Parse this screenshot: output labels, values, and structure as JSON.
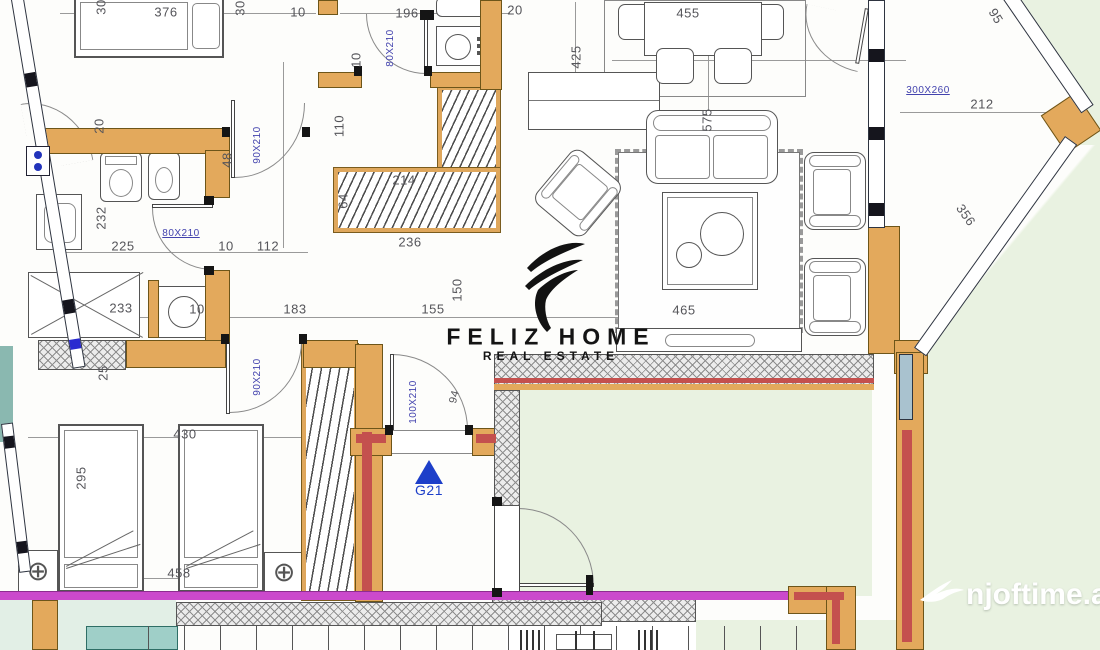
{
  "labels": {
    "b1_width": "376",
    "top_10": "10",
    "top_30a": "30",
    "top_30b": "30",
    "bath2_width": "196",
    "top_20": "20",
    "dining_width": "455",
    "bay_top": "95",
    "left_20": "20",
    "bed1_door": "90X210",
    "bath2_door": "80X210",
    "kitchen_h": "425",
    "hall_110": "110",
    "bath2_10": "10",
    "door_48": "48",
    "bath1_h": "232",
    "bath1_w": "225",
    "bath1_door": "80X210",
    "hall_10": "10",
    "hall_112": "112",
    "ward_64": "64",
    "ward_214": "214",
    "ward_236": "236",
    "living_h": "575",
    "shower_233": "233",
    "wash_10": "10",
    "hall_183": "183",
    "hall_155": "155",
    "hall_150": "150",
    "bay_tag": "300X260",
    "bay_212": "212",
    "bay_356": "356",
    "rug_465": "465",
    "bed2_25": "25",
    "bed2_door": "90X210",
    "entry_door": "100X210",
    "entry_94": "94",
    "bed2_430": "430",
    "bed2_295": "295",
    "bed2_458": "458",
    "gate": "G21"
  },
  "watermarks": {
    "brand": "FELIZ HOME",
    "brand_sub": "REAL ESTATE",
    "site": "njoftime.al"
  },
  "icons": {
    "entry_marker": "triangle-up",
    "site_bird": "bird",
    "brand_logo": "swoosh"
  },
  "colors": {
    "wall": "#e3a95c",
    "wall_core": "#c4504e",
    "balcony_line": "#cb49cc",
    "door_tag": "#4343ae",
    "entry_marker": "#1d3fc9",
    "outside": "#e9f2e1",
    "teal": "#8ab8b0"
  }
}
